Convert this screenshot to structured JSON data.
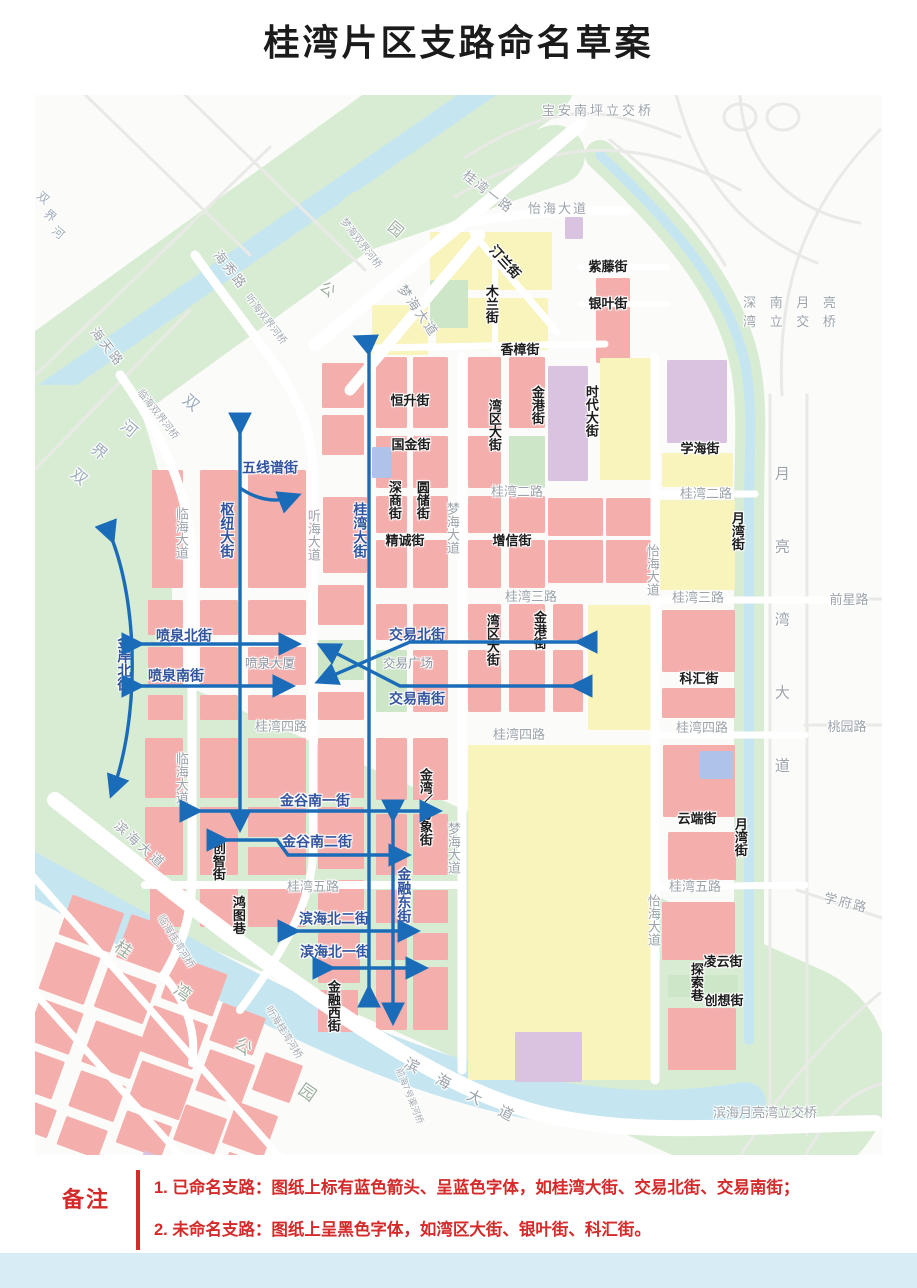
{
  "title": "桂湾片区支路命名草案",
  "notes": {
    "heading": "备注",
    "line1": "1. 已命名支路：图纸上标有蓝色箭头、呈蓝色字体，如桂湾大街、交易北街、交易南街；",
    "line2": "2. 未命名支路：图纸上呈黑色字体，如湾区大街、银叶街、科汇街。"
  },
  "legend_colors": {
    "named_street_blue": "#32549e",
    "arrow_blue": "#1b6cb8",
    "unnamed_street_black": "#1c1c1c",
    "road_gray": "#9ca3ab",
    "note_red": "#d42a2a"
  },
  "map": {
    "labels": [
      {
        "id": "baoan-nanping-interchange",
        "t": "宝安南坪立交桥",
        "x": 563,
        "y": 16,
        "k": "road",
        "ls": 3
      },
      {
        "id": "guiwan-1-rd",
        "t": "桂湾一路",
        "x": 453,
        "y": 97,
        "k": "road",
        "r": 38,
        "ls": 2
      },
      {
        "id": "yihai-ave-top",
        "t": "怡海大道",
        "x": 523,
        "y": 114,
        "k": "road",
        "ls": 2
      },
      {
        "id": "haixiu-rd",
        "t": "海秀路",
        "x": 195,
        "y": 175,
        "k": "road",
        "r": 52,
        "ls": 2
      },
      {
        "id": "haitian-rd",
        "t": "海天路",
        "x": 72,
        "y": 252,
        "k": "road",
        "r": 52,
        "ls": 2
      },
      {
        "id": "tinghai-shuangjie-bridge",
        "t": "听海双界河桥",
        "x": 230,
        "y": 225,
        "k": "bridge",
        "r": 52
      },
      {
        "id": "menghai-shuangjie-bridge",
        "t": "梦海双界河桥",
        "x": 325,
        "y": 149,
        "k": "bridge",
        "r": 52
      },
      {
        "id": "linhai-shuangjie-bridge",
        "t": "临海双界河桥",
        "x": 122,
        "y": 320,
        "k": "bridge",
        "r": 52
      },
      {
        "id": "menghai-ave-diag",
        "t": "梦海大道",
        "x": 383,
        "y": 216,
        "k": "road",
        "r": 55,
        "ls": 2
      },
      {
        "id": "shuangjie-river-char-a1",
        "t": "双",
        "x": 8,
        "y": 103,
        "k": "river",
        "r": 40,
        "s": 12
      },
      {
        "id": "shuangjie-river-char-a2",
        "t": "界",
        "x": 15,
        "y": 121,
        "k": "river",
        "r": 40,
        "s": 12
      },
      {
        "id": "shuangjie-river-char-a3",
        "t": "河",
        "x": 23,
        "y": 138,
        "k": "river",
        "r": 40,
        "s": 12
      },
      {
        "id": "shuangjie-river-char-b1",
        "t": "双",
        "x": 43,
        "y": 383,
        "k": "river",
        "r": 40
      },
      {
        "id": "shuangjie-river-char-b2",
        "t": "界",
        "x": 63,
        "y": 358,
        "k": "river",
        "r": 40
      },
      {
        "id": "shuangjie-river-char-b3",
        "t": "河",
        "x": 93,
        "y": 335,
        "k": "river",
        "r": 40
      },
      {
        "id": "shuangjie-river-char-b4",
        "t": "双",
        "x": 155,
        "y": 309,
        "k": "river",
        "r": 40
      },
      {
        "id": "linhai-ave-1",
        "t": "临海大道",
        "x": 146,
        "y": 438,
        "k": "road",
        "v": 1
      },
      {
        "id": "linhai-ave-2",
        "t": "临海大道",
        "x": 146,
        "y": 683,
        "k": "road",
        "v": 1
      },
      {
        "id": "tinghai-ave",
        "t": "听海大道",
        "x": 278,
        "y": 440,
        "k": "road",
        "v": 1
      },
      {
        "id": "menghai-ave-1",
        "t": "梦海大道",
        "x": 417,
        "y": 433,
        "k": "road",
        "v": 1
      },
      {
        "id": "menghai-ave-2",
        "t": "梦海大道",
        "x": 418,
        "y": 753,
        "k": "road",
        "v": 1
      },
      {
        "id": "yihai-ave-1",
        "t": "怡海大道",
        "x": 617,
        "y": 475,
        "k": "road",
        "v": 1
      },
      {
        "id": "yihai-ave-2",
        "t": "怡海大道",
        "x": 618,
        "y": 825,
        "k": "road",
        "v": 1
      },
      {
        "id": "guiwan-2-rd-c",
        "t": "桂湾二路",
        "x": 482,
        "y": 397,
        "k": "road"
      },
      {
        "id": "guiwan-2-rd-r",
        "t": "桂湾二路",
        "x": 671,
        "y": 399,
        "k": "road"
      },
      {
        "id": "guiwan-3-rd-c",
        "t": "桂湾三路",
        "x": 496,
        "y": 502,
        "k": "road"
      },
      {
        "id": "guiwan-3-rd-r",
        "t": "桂湾三路",
        "x": 663,
        "y": 503,
        "k": "road"
      },
      {
        "id": "qianxing-rd",
        "t": "前星路",
        "x": 814,
        "y": 505,
        "k": "road"
      },
      {
        "id": "guiwan-4-rd-l",
        "t": "桂湾四路",
        "x": 246,
        "y": 632,
        "k": "road"
      },
      {
        "id": "guiwan-4-rd-c",
        "t": "桂湾四路",
        "x": 484,
        "y": 640,
        "k": "road"
      },
      {
        "id": "guiwan-4-rd-r",
        "t": "桂湾四路",
        "x": 667,
        "y": 633,
        "k": "road"
      },
      {
        "id": "taoyuan-rd",
        "t": "桃园路",
        "x": 812,
        "y": 632,
        "k": "road"
      },
      {
        "id": "guiwan-5-rd-c",
        "t": "桂湾五路",
        "x": 278,
        "y": 792,
        "k": "road"
      },
      {
        "id": "guiwan-5-rd-r",
        "t": "桂湾五路",
        "x": 660,
        "y": 792,
        "k": "road"
      },
      {
        "id": "xuefu-rd",
        "t": "学府路",
        "x": 811,
        "y": 808,
        "k": "road",
        "r": 14,
        "ls": 2
      },
      {
        "id": "yueliangwan-ave",
        "t": "月亮湾大道",
        "x": 746,
        "y": 553,
        "k": "road",
        "v": 1,
        "ls": 58,
        "s": 15
      },
      {
        "id": "shennan-yueliangwan-line1",
        "t": "深 南 月 亮",
        "x": 757,
        "y": 208,
        "k": "road",
        "ls": 5
      },
      {
        "id": "shennan-yueliangwan-line2",
        "t": "湾 立 交 桥",
        "x": 757,
        "y": 227,
        "k": "road",
        "ls": 5
      },
      {
        "id": "binhai-yueliangwan-interchange",
        "t": "滨海月亮湾立交桥",
        "x": 730,
        "y": 1018,
        "k": "road"
      },
      {
        "id": "binhai-ave-se",
        "t": "滨 海 大 道",
        "x": 427,
        "y": 997,
        "k": "road",
        "r": 27,
        "ls": 8,
        "s": 15
      },
      {
        "id": "binhai-ave-w",
        "t": "滨海大道",
        "x": 105,
        "y": 750,
        "k": "road",
        "r": 42,
        "ls": 3
      },
      {
        "id": "qianhai-7-bridge",
        "t": "前海7号渠河桥",
        "x": 374,
        "y": 1001,
        "k": "bridge",
        "r": 68,
        "s": 9
      },
      {
        "id": "tinghai-guiwan-bridge",
        "t": "听海桂湾河桥",
        "x": 248,
        "y": 938,
        "k": "bridge",
        "r": 58
      },
      {
        "id": "linhai-guiwan-bridge",
        "t": "临海桂湾河桥",
        "x": 140,
        "y": 847,
        "k": "bridge",
        "r": 58
      },
      {
        "id": "guiwan-park-char-1",
        "t": "桂",
        "x": 88,
        "y": 855,
        "k": "park",
        "r": 35
      },
      {
        "id": "guiwan-park-char-2",
        "t": "湾",
        "x": 147,
        "y": 898,
        "k": "park",
        "r": 35
      },
      {
        "id": "guiwan-park-char-3",
        "t": "公",
        "x": 208,
        "y": 952,
        "k": "park",
        "r": 35
      },
      {
        "id": "guiwan-park-char-4",
        "t": "园",
        "x": 272,
        "y": 998,
        "k": "park",
        "r": 35
      },
      {
        "id": "park-char-yuan",
        "t": "园",
        "x": 360,
        "y": 135,
        "k": "park",
        "r": 40,
        "s": 15
      },
      {
        "id": "park-char-gong",
        "t": "公",
        "x": 292,
        "y": 195,
        "k": "park",
        "r": 40,
        "s": 15
      },
      {
        "id": "fountain-tower",
        "t": "喷泉大厦",
        "x": 235,
        "y": 569,
        "k": "poi"
      },
      {
        "id": "trade-plaza",
        "t": "交易广场",
        "x": 373,
        "y": 569,
        "k": "poi"
      },
      {
        "id": "tinglan-st",
        "t": "汀兰街",
        "x": 470,
        "y": 167,
        "k": "black",
        "r": 48
      },
      {
        "id": "mulan-st",
        "t": "木兰街",
        "x": 456,
        "y": 209,
        "k": "black",
        "v": 1
      },
      {
        "id": "ziteng-st",
        "t": "紫藤街",
        "x": 573,
        "y": 172,
        "k": "black"
      },
      {
        "id": "yinye-st",
        "t": "银叶街",
        "x": 573,
        "y": 209,
        "k": "black"
      },
      {
        "id": "xiangzhang-st",
        "t": "香樟街",
        "x": 485,
        "y": 255,
        "k": "black"
      },
      {
        "id": "hengsheng-st",
        "t": "恒升街",
        "x": 375,
        "y": 306,
        "k": "black"
      },
      {
        "id": "guojin-st",
        "t": "国金街",
        "x": 376,
        "y": 350,
        "k": "black"
      },
      {
        "id": "shenshang-st",
        "t": "深商街",
        "x": 359,
        "y": 405,
        "k": "black",
        "v": 1
      },
      {
        "id": "yuanchu-st",
        "t": "圆储街",
        "x": 387,
        "y": 405,
        "k": "black",
        "v": 1
      },
      {
        "id": "jingcheng-st",
        "t": "精诚街",
        "x": 370,
        "y": 446,
        "k": "black"
      },
      {
        "id": "wanqu-ave-n",
        "t": "湾区大街",
        "x": 459,
        "y": 330,
        "k": "black",
        "v": 1
      },
      {
        "id": "jingang-st-n",
        "t": "金港街",
        "x": 502,
        "y": 310,
        "k": "black",
        "v": 1
      },
      {
        "id": "shidai-ave",
        "t": "时代大街",
        "x": 556,
        "y": 316,
        "k": "black",
        "v": 1
      },
      {
        "id": "zengxin-st",
        "t": "增信街",
        "x": 477,
        "y": 446,
        "k": "black"
      },
      {
        "id": "wanqu-ave-s",
        "t": "湾区大街",
        "x": 457,
        "y": 545,
        "k": "black",
        "v": 1
      },
      {
        "id": "jingang-st-s",
        "t": "金港街",
        "x": 504,
        "y": 535,
        "k": "black",
        "v": 1
      },
      {
        "id": "xuehai-st",
        "t": "学海街",
        "x": 665,
        "y": 354,
        "k": "black"
      },
      {
        "id": "yuewan-st-n",
        "t": "月湾街",
        "x": 702,
        "y": 436,
        "k": "black",
        "v": 1
      },
      {
        "id": "kehui-st",
        "t": "科汇街",
        "x": 664,
        "y": 584,
        "k": "black"
      },
      {
        "id": "yunduan-st",
        "t": "云端街",
        "x": 662,
        "y": 724,
        "k": "black"
      },
      {
        "id": "yuewan-st-s",
        "t": "月湾街",
        "x": 705,
        "y": 742,
        "k": "black",
        "v": 1
      },
      {
        "id": "lingyun-st",
        "t": "凌云街",
        "x": 688,
        "y": 867,
        "k": "black"
      },
      {
        "id": "tansuo-lane",
        "t": "探索巷",
        "x": 661,
        "y": 887,
        "k": "black",
        "v": 1
      },
      {
        "id": "chuangxiang-st",
        "t": "创想街",
        "x": 689,
        "y": 906,
        "k": "black"
      },
      {
        "id": "chuangzhi-st",
        "t": "创智街",
        "x": 183,
        "y": 766,
        "k": "black",
        "v": 1
      },
      {
        "id": "hongtu-lane",
        "t": "鸿图巷",
        "x": 203,
        "y": 820,
        "k": "black",
        "v": 1
      },
      {
        "id": "jinrong-xi-st",
        "t": "金融西街",
        "x": 298,
        "y": 911,
        "k": "black",
        "v": 1
      },
      {
        "id": "jinwan-wanxiang-st",
        "t": "金湾／万象街",
        "x": 390,
        "y": 712,
        "k": "black",
        "v": 1
      },
      {
        "id": "wuxianpu-st",
        "t": "五线谱街",
        "x": 235,
        "y": 373,
        "k": "blue"
      },
      {
        "id": "shuniu-ave",
        "t": "枢纽大街",
        "x": 192,
        "y": 435,
        "k": "blue",
        "v": 1
      },
      {
        "id": "guiwan-ave",
        "t": "桂湾大街",
        "x": 325,
        "y": 435,
        "k": "blue",
        "v": 1
      },
      {
        "id": "penquan-bei-st",
        "t": "喷泉北街",
        "x": 149,
        "y": 541,
        "k": "blue"
      },
      {
        "id": "penquan-nan-st",
        "t": "喷泉南街",
        "x": 141,
        "y": 581,
        "k": "blue"
      },
      {
        "id": "jinan-bei-st",
        "t": "金岸北街",
        "x": 89,
        "y": 568,
        "k": "blue",
        "v": 1
      },
      {
        "id": "jiaoyi-bei-st",
        "t": "交易北街",
        "x": 382,
        "y": 540,
        "k": "blue"
      },
      {
        "id": "jiaoyi-nan-st",
        "t": "交易南街",
        "x": 382,
        "y": 604,
        "k": "blue"
      },
      {
        "id": "jingu-nan-1-st",
        "t": "金谷南一街",
        "x": 280,
        "y": 706,
        "k": "blue"
      },
      {
        "id": "jingu-nan-2-st",
        "t": "金谷南二街",
        "x": 282,
        "y": 747,
        "k": "blue"
      },
      {
        "id": "binhai-bei-2-st",
        "t": "滨海北二街",
        "x": 299,
        "y": 824,
        "k": "blue"
      },
      {
        "id": "binhai-bei-1-st",
        "t": "滨海北一街",
        "x": 300,
        "y": 857,
        "k": "blue"
      },
      {
        "id": "jinrong-dong-st",
        "t": "金融东街",
        "x": 369,
        "y": 800,
        "k": "blue",
        "v": 1
      }
    ]
  }
}
